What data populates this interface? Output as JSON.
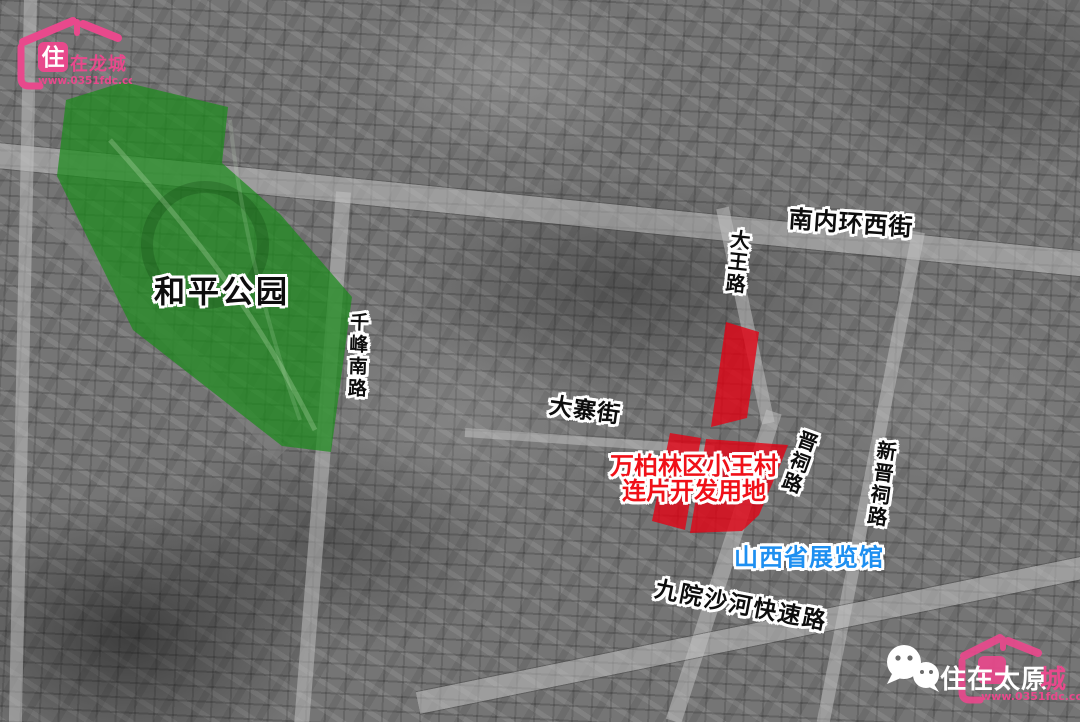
{
  "watermark_top_left": {
    "house_char": "住",
    "brand": "在龙城",
    "url": "www.0351fdc.com"
  },
  "watermark_bottom_right": {
    "brand_white": "住在太原",
    "brand_pink": "城",
    "url": "www.0351fdc.com"
  },
  "map": {
    "park": {
      "label": "和平公园"
    },
    "development": {
      "line1": "万柏林区小王村",
      "line2": "连片开发用地"
    },
    "poi": {
      "exhibition": "山西省展览馆"
    },
    "roads": [
      {
        "name": "南内环西街"
      },
      {
        "name": "大王路"
      },
      {
        "name": "千峰南路"
      },
      {
        "name": "大寨街"
      },
      {
        "name": "晋祠路"
      },
      {
        "name": "新晋祠路"
      },
      {
        "name": "九院沙河快速路"
      }
    ]
  },
  "colors": {
    "brand_pink": "#e8498c",
    "park_green": "#1c8c1c",
    "development_red": "#e60012",
    "development_text_red": "#f01018",
    "poi_blue": "#1e8ff0",
    "road_label_black": "#0d0d0d"
  }
}
